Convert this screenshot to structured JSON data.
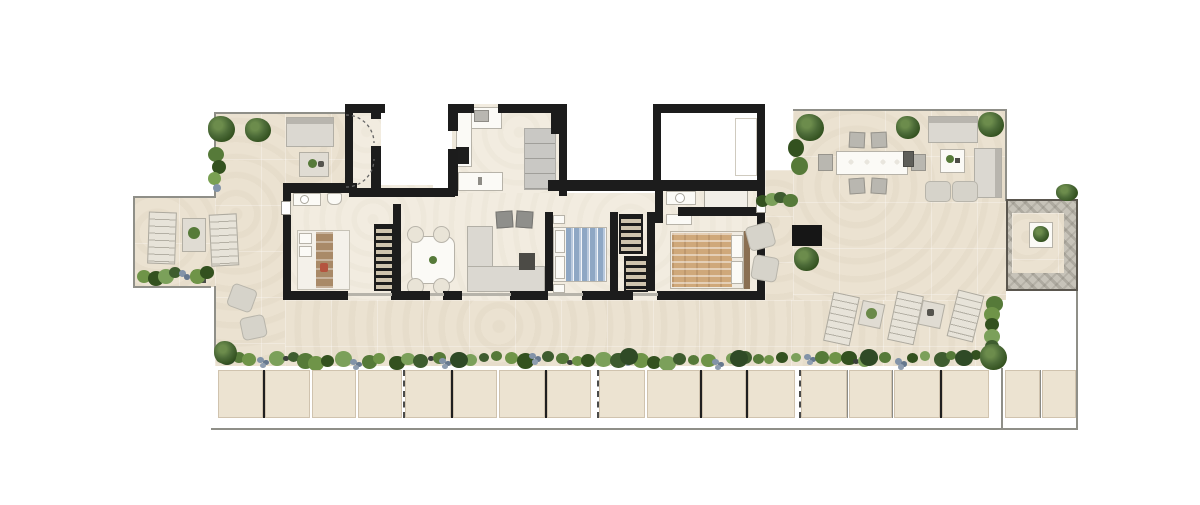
{
  "document": {
    "kind": "residential floor plan",
    "style": "rendered top-down marketing plan, no text labels",
    "visible_text": []
  },
  "palette": {
    "background": "#ffffff",
    "terrace_floor": "#ebe2d1",
    "interior_floor": "#f2ece0",
    "wall": "#1c1c1c",
    "boundary_line": "#8f8f88",
    "furniture_light": "#dbd8d1",
    "furniture_gray": "#b9b7b0",
    "cabinet_gray": "#c9c8c4",
    "bed_blue": "#8ea7c4",
    "bed_tan": "#cfa87a",
    "wood_dark": "#8a6f52",
    "plant_dark": "#33511f",
    "plant_mid": "#567a39",
    "plant_light": "#79a052",
    "plant_gray_blue": "#8293a8",
    "gravel": "#c7c3b9",
    "panel_beige": "#ece3d1"
  },
  "rooms": [
    "entry-hall",
    "stair-core",
    "kitchen",
    "living-dining-room",
    "bedroom-1",
    "bathroom-1",
    "bedroom-2",
    "walk-in-wardrobe",
    "master-bedroom",
    "master-bathroom",
    "hallway"
  ],
  "outdoor_areas": [
    "top-left-terrace",
    "left-terrace-wing",
    "front-terrace",
    "outdoor-dining-terrace",
    "lounge-terrace",
    "sunbathing-deck",
    "gravel-patio",
    "perimeter-planting-bed",
    "parapet-panels"
  ],
  "furniture_indoor": [
    "double-bed-white",
    "double-bed-blue",
    "double-bed-tan",
    "wardrobe",
    "walk-in-closet-units",
    "dining-table-4-chairs",
    "l-shaped-sofa",
    "armchairs",
    "coffee-table",
    "kitchen-counter",
    "kitchen-island",
    "cooktop",
    "tall-cabinets",
    "vanity-basin",
    "toilet",
    "shower",
    "dresser",
    "nightstands"
  ],
  "furniture_outdoor": [
    "outdoor-sofa",
    "outdoor-coffee-table",
    "outdoor-dining-table-6-chairs",
    "sun-loungers",
    "side-tables",
    "ottomans",
    "potted-trees",
    "shrubs",
    "planter-box",
    "fire-table"
  ]
}
